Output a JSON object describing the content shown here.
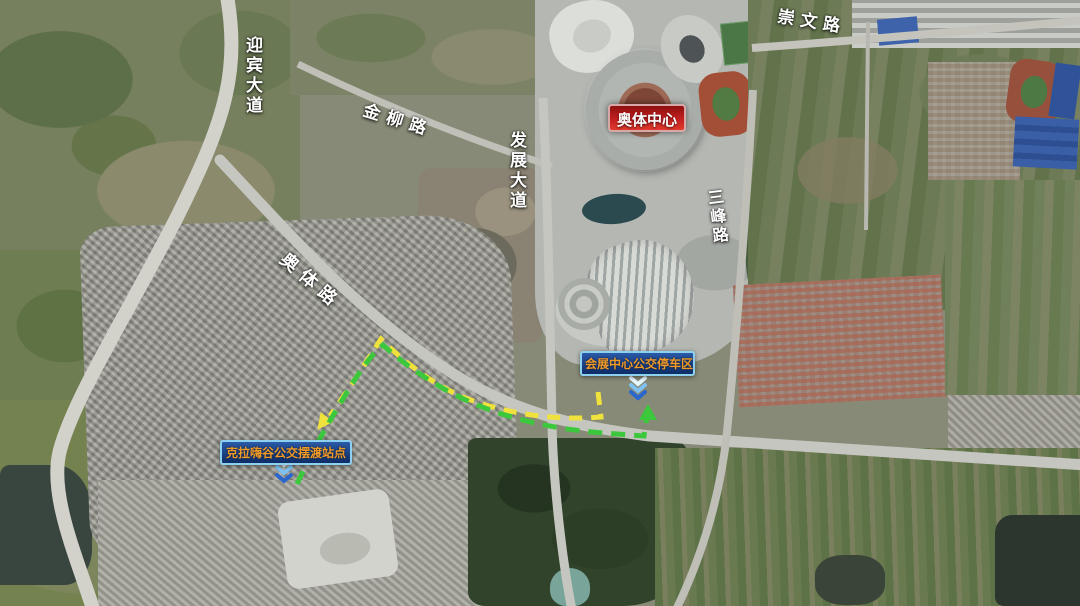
{
  "map": {
    "type": "satellite",
    "road_labels": {
      "chongwen": "崇文路",
      "yingbin": "迎宾大道",
      "jinliu": "金柳路",
      "fazhan": "发展大道",
      "sanfeng": "三峰路",
      "aoti": "奥体路"
    },
    "pois": {
      "stadium_badge": "奥体中心",
      "parking_label": "会展中心公交停车区",
      "shuttle_label": "克拉嗨谷公交摆渡站点"
    },
    "routes": {
      "yellow": {
        "color": "#f0e23c",
        "style": "dashed",
        "arrow_points": "southwest toward shuttle station"
      },
      "green": {
        "color": "#3cc83c",
        "style": "dashed",
        "arrow_points": "north toward parking area"
      }
    },
    "colors": {
      "badge_red": "#c21f1f",
      "label_bg": "#0e2d66",
      "label_border": "#8ed0f0",
      "label_text": "#f09a28",
      "road_label_text": "#ffffff"
    }
  }
}
